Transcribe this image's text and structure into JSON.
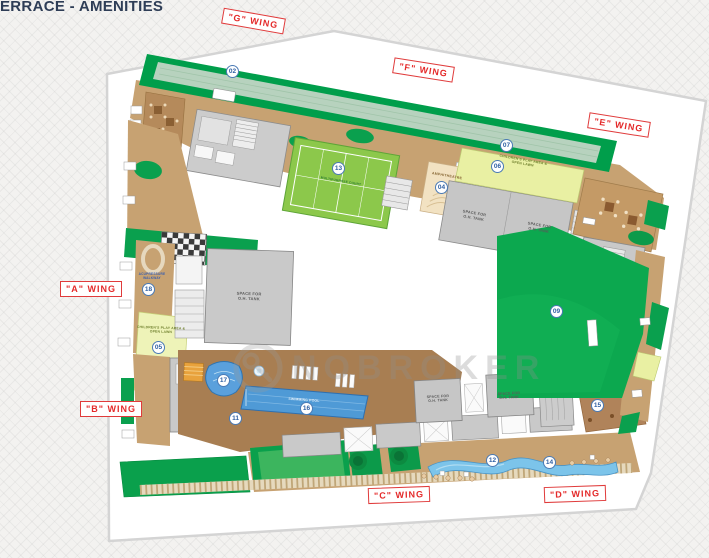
{
  "title": "ERRACE - AMENITIES",
  "watermark": {
    "text": "NOBROKER",
    "logo_icon": "key-in-circle"
  },
  "colors": {
    "lawn_green": "#0aa04c",
    "court_green": "#8cc84b",
    "path_tan": "#c7a272",
    "deck_brown": "#a87e52",
    "pool_blue": "#4f9ad6",
    "building_gray": "#c9c9c9",
    "amphitheatre_cream": "#f2e2c2",
    "play_area_yellow": "#eef3b8",
    "wing_label_red": "#e42a2a",
    "marker_blue": "#2e5fa3",
    "title_navy": "#2e3d56"
  },
  "wings": [
    {
      "label": "\"G\" WING",
      "x": 222,
      "y": 13,
      "rot": 10
    },
    {
      "label": "\"F\" WING",
      "x": 393,
      "y": 62,
      "rot": 9
    },
    {
      "label": "\"E\" WING",
      "x": 588,
      "y": 117,
      "rot": 9
    },
    {
      "label": "\"A\" WING",
      "x": 60,
      "y": 281,
      "rot": 0
    },
    {
      "label": "\"B\" WING",
      "x": 80,
      "y": 401,
      "rot": 0
    },
    {
      "label": "\"C\" WING",
      "x": 368,
      "y": 487,
      "rot": -2
    },
    {
      "label": "\"D\" WING",
      "x": 544,
      "y": 486,
      "rot": -2
    }
  ],
  "markers": [
    {
      "num": "02",
      "x": 233,
      "y": 72
    },
    {
      "num": "04",
      "x": 442,
      "y": 188
    },
    {
      "num": "05",
      "x": 159,
      "y": 348
    },
    {
      "num": "06",
      "x": 498,
      "y": 167
    },
    {
      "num": "07",
      "x": 507,
      "y": 146
    },
    {
      "num": "09",
      "x": 557,
      "y": 312
    },
    {
      "num": "11",
      "x": 236,
      "y": 419
    },
    {
      "num": "12",
      "x": 493,
      "y": 461
    },
    {
      "num": "13",
      "x": 339,
      "y": 169
    },
    {
      "num": "14",
      "x": 550,
      "y": 463
    },
    {
      "num": "15",
      "x": 598,
      "y": 406
    },
    {
      "num": "16",
      "x": 307,
      "y": 409
    },
    {
      "num": "17",
      "x": 224,
      "y": 381
    },
    {
      "num": "18",
      "x": 149,
      "y": 290
    }
  ],
  "area_labels": [
    {
      "text": "AMPHITHEATRE",
      "x": 447,
      "y": 176,
      "rot": 10,
      "color": "#8a6a38",
      "size": 3.6
    },
    {
      "text": "CHILDREN'S PLAY AREA &\nOPEN LAWN",
      "x": 523,
      "y": 162,
      "rot": 10,
      "color": "#70802e",
      "size": 3.4
    },
    {
      "text": "CHILDREN'S PLAY AREA &\nOPEN LAWN",
      "x": 161,
      "y": 330,
      "rot": 2,
      "color": "#70802e",
      "size": 3.4
    },
    {
      "text": "ACUPRESSURE\nWALKWAY",
      "x": 152,
      "y": 276,
      "rot": 0,
      "color": "#3a5fae",
      "size": 3.2
    },
    {
      "text": "MULTIPURPOSE COURT",
      "x": 341,
      "y": 181,
      "rot": 10,
      "color": "#2e7d32",
      "size": 3.2
    },
    {
      "text": "SWIMMING POOL",
      "x": 304,
      "y": 400,
      "rot": 4,
      "color": "#eaf4fc",
      "size": 3.4
    },
    {
      "text": "SPACE FOR\nO.H. TANK",
      "x": 474,
      "y": 216,
      "rot": 10,
      "color": "#5a5a5a",
      "size": 3.8
    },
    {
      "text": "SPACE FOR\nO.H. TANK",
      "x": 539,
      "y": 228,
      "rot": 10,
      "color": "#5a5a5a",
      "size": 3.8
    },
    {
      "text": "SPACE FOR\nO.H. TANK",
      "x": 249,
      "y": 296,
      "rot": 2,
      "color": "#5a5a5a",
      "size": 4
    },
    {
      "text": "SPACE FOR\nO.H. TANK",
      "x": 438,
      "y": 399,
      "rot": -3,
      "color": "#5a5a5a",
      "size": 3.6
    },
    {
      "text": "SPACE FOR\nO.H. TANK",
      "x": 509,
      "y": 396,
      "rot": -3,
      "color": "#5a5a5a",
      "size": 3.6
    }
  ]
}
